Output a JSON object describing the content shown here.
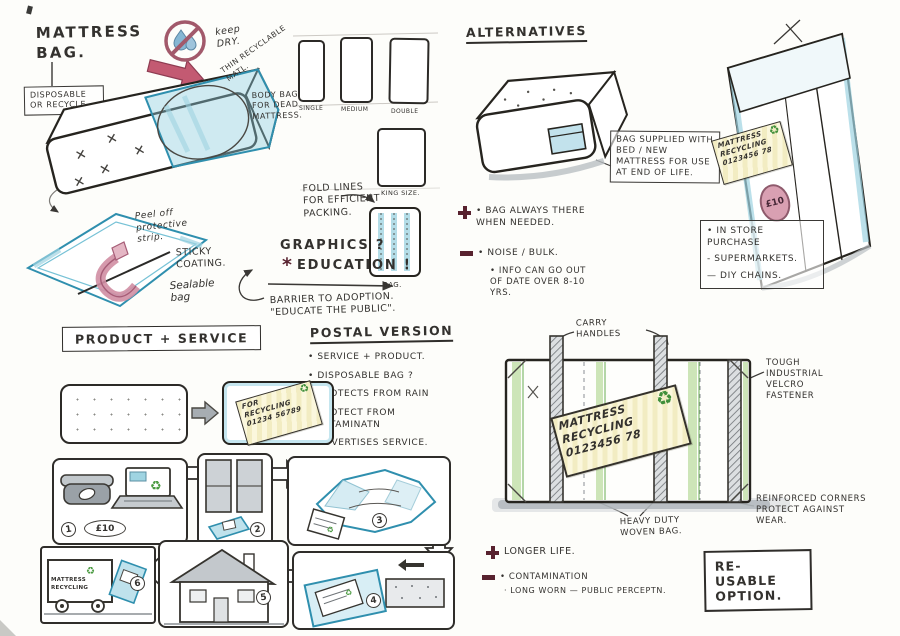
{
  "palette": {
    "ink": "#33312e",
    "marker_blue": "#8fcbdc",
    "marker_blue_dark": "#2f8fae",
    "marker_pink": "#cf8ba0",
    "marker_maroon": "#58222f",
    "marker_green": "#4a9a40",
    "marker_green_light": "#aed68c",
    "tag_yellow": "#f2ecc2",
    "marker_grey": "#aab0b5",
    "paper": "#fdfdfa"
  },
  "icons": {
    "recycle": "♻",
    "education_star": "*"
  },
  "concept": {
    "title": "MATTRESS BAG.",
    "disposable_note": "DISPOSABLE OR RECYCLE",
    "keep_dry": "keep DRY.",
    "thin_material": "THIN RECYCLABLE MATL.",
    "body_bag_note": "BODY BAG FOR DEAD MATTRESS.",
    "size_labels": [
      "SINGLE",
      "MEDIUM",
      "DOUBLE"
    ],
    "king_size": "KING SIZE.",
    "fold_lines": "FOLD LINES FOR EFFICIENT PACKING.",
    "bag_caption": "BAG.",
    "graphics": "GRAPHICS ?",
    "education": "EDUCATION !",
    "barrier_line1": "BARRIER TO ADOPTION.",
    "barrier_line2": "\"EDUCATE THE PUBLIC\".",
    "peel_strip": "Peel off protective strip.",
    "sticky_coating": "STICKY COATING.",
    "sealable_bag": "Sealable bag"
  },
  "alternatives": {
    "heading": "ALTERNATIVES",
    "supplied_note": "BAG SUPPLIED WITH BED / NEW MATTRESS FOR USE AT END OF LIFE.",
    "pro_note": "• BAG ALWAYS THERE WHEN NEEDED.",
    "con_note": "• NOISE / BULK.",
    "info_note": "• INFO CAN GO OUT OF DATE OVER 8-10 YRS.",
    "tag": {
      "line1": "MATTRESS",
      "line2": "RECYCLING",
      "line3": "0123456 78"
    },
    "price_sticker": "£10",
    "store_heading": "• IN STORE PURCHASE",
    "store_items": [
      "- SUPERMARKETS.",
      "— DIY CHAINS."
    ]
  },
  "product_service": {
    "heading": "PRODUCT + SERVICE",
    "postal_heading": "POSTAL VERSION",
    "postal_points": [
      "• SERVICE + PRODUCT.",
      "• DISPOSABLE BAG ?",
      "• PROTECTS FROM RAIN",
      "• PROTECT FROM CONTAMINATN",
      "• ADVERTISES SERVICE.",
      "• REASSURES PUBLIC."
    ],
    "bag_label": {
      "line1": "FOR",
      "line2": "RECYCLING",
      "line3": "01234 56789"
    },
    "order_price": "£10",
    "truck_sign": "MATTRESS RECYCLING",
    "steps": [
      "1",
      "2",
      "3",
      "4",
      "5",
      "6"
    ]
  },
  "reusable": {
    "carry_handles": "CARRY HANDLES",
    "velcro_note": "TOUGH INDUSTRIAL VELCRO FASTENER",
    "tag": {
      "line1": "MATTRESS",
      "line2": "RECYCLING",
      "line3": "0123456 78"
    },
    "heavy_duty_note": "HEAVY DUTY WOVEN BAG.",
    "reinforced_note": "REINFORCED CORNERS PROTECT AGAINST WEAR.",
    "pro_note": "LONGER LIFE.",
    "con_note": "• CONTAMINATION",
    "con_sub_note": "· LONG WORN — PUBLIC PERCEPTN.",
    "option_label": "RE-USABLE OPTION."
  }
}
